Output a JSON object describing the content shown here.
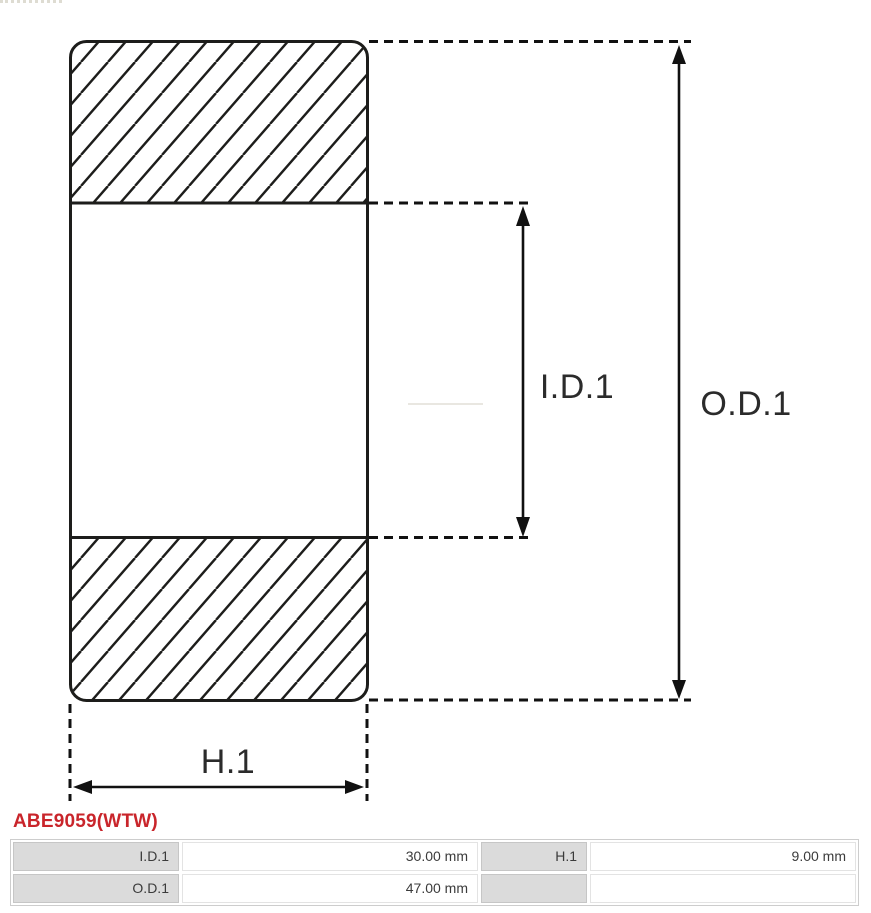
{
  "diagram": {
    "type": "bearing-cross-section",
    "line_color": "#1d1d1b",
    "labels": {
      "inner_diameter": "I.D.1",
      "outer_diameter": "O.D.1",
      "height": "H.1"
    }
  },
  "part_number": {
    "text": "ABE9059(WTW)",
    "color": "#c9252b"
  },
  "specs_table": {
    "rows": [
      {
        "label_1": "I.D.1",
        "value_1": "30.00 mm",
        "label_2": "H.1",
        "value_2": "9.00 mm"
      },
      {
        "label_1": "O.D.1",
        "value_1": "47.00 mm",
        "label_2": "",
        "value_2": ""
      }
    ]
  }
}
